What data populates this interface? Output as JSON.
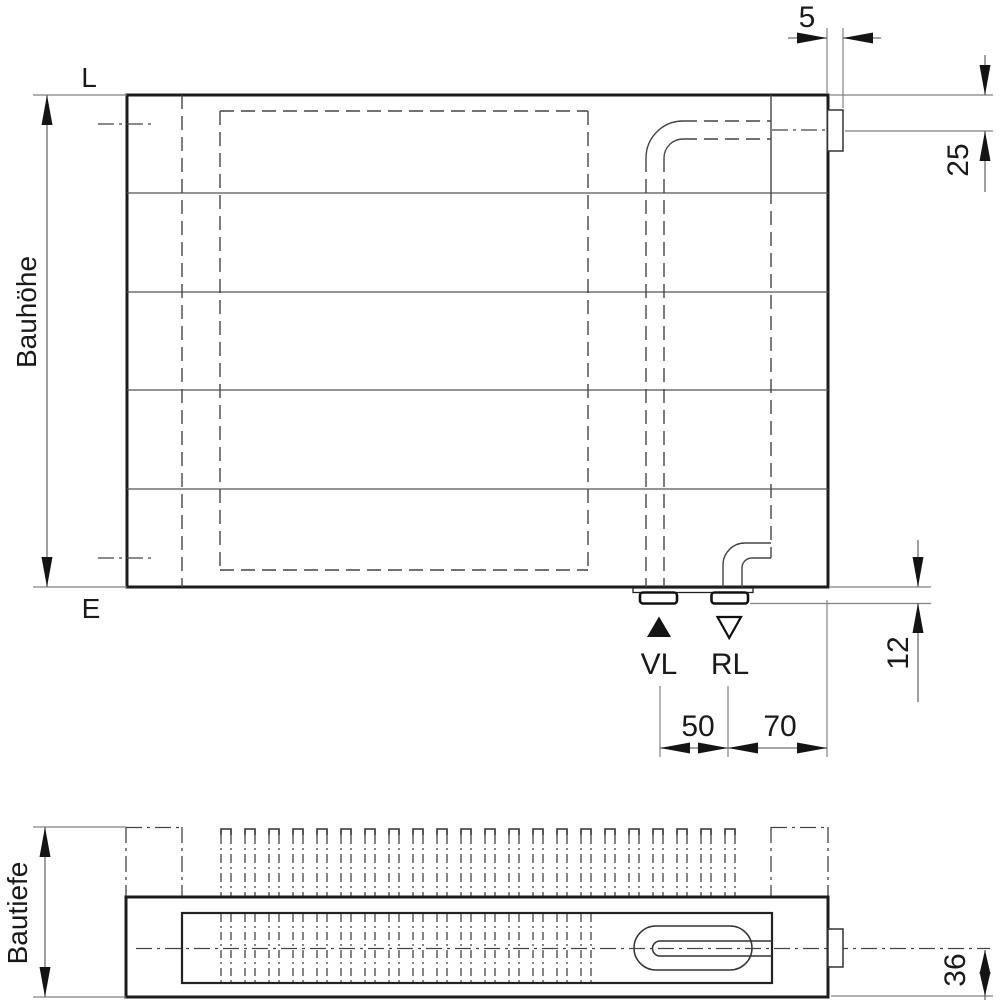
{
  "drawing": {
    "type": "radiator-technical-drawing",
    "views": {
      "front": {
        "label_top_left": "L",
        "label_bottom_left": "E",
        "height_label": "Bauhöhe",
        "flow_label": "VL",
        "return_label": "RL"
      },
      "bottom": {
        "depth_label": "Bautiefe"
      }
    },
    "dims": {
      "tab_width": "5",
      "top_connection_offset": "25",
      "stub_height": "12",
      "vl_rl_distance": "50",
      "rl_to_edge": "70",
      "center_to_bottom": "36"
    },
    "line_color": "#1a1a1a"
  },
  "pattern": {
    "fins": {
      "start_x": 221,
      "pitch": 24,
      "width": 10,
      "count": 22,
      "top_y": 829,
      "bottom_y": 896
    },
    "hatch": {
      "start_x": 221,
      "pitch": 24,
      "width": 10,
      "count": 16,
      "top_y": 914,
      "bottom_y": 982
    }
  }
}
